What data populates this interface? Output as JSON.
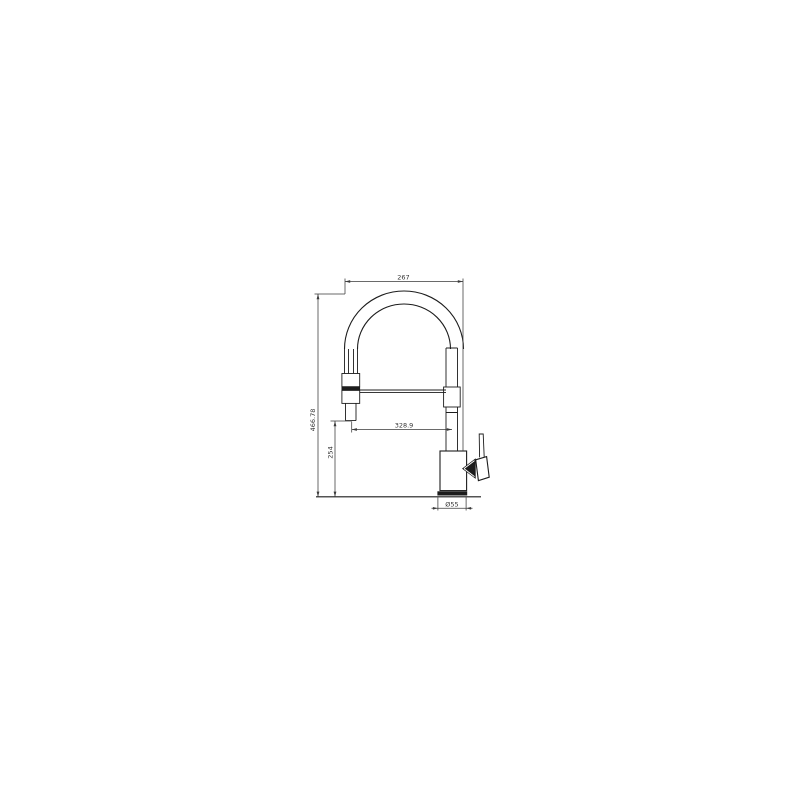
{
  "page": {
    "background": "#ffffff"
  },
  "drawing": {
    "subject": "pull-down kitchen faucet with spring spout, front elevation technical drawing",
    "line_color": "#1c1c1c",
    "dimension_color": "#3a3a3a",
    "labels": {
      "overall_width": "267",
      "overall_height": "466.78",
      "outlet_height": "254",
      "spout_reach": "328.9",
      "base_diameter": "Ø55"
    }
  }
}
